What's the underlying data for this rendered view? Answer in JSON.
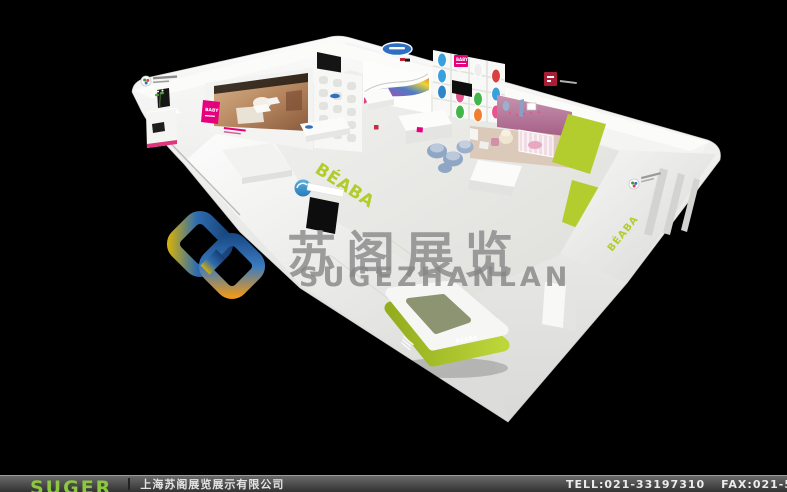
{
  "window": {
    "width": 787,
    "height": 492,
    "background": "#000000"
  },
  "booth": {
    "type": "3d-exhibition-booth-render",
    "fascia_brand": "BÉABA",
    "counter_brand": "BÉABA",
    "sidewall_brand": "BÉABA",
    "shelf_brand": "BABY",
    "left_brand": "BABY",
    "colors": {
      "structure_white": "#f2f2f0",
      "accent_lime": "#b2cc2b",
      "brand_pink": "#e6007e",
      "brand_dark_red": "#a81f35",
      "sign_blue": "#2e6fc2",
      "nursery_mauve": "#b77b9d",
      "nursery_floor_tan": "#dbc9ba",
      "product_blue": "#3aa0dc",
      "product_green": "#42b64a",
      "product_pink": "#e8558e",
      "product_orange": "#f08030",
      "product_red": "#d94040"
    }
  },
  "watermark": {
    "title": "苏阁展览",
    "subtitle": "SUGEZHANLAN",
    "text_color": "#8e8e8e",
    "logo_colors": {
      "gold": "#d2af10",
      "blue": "#1c4e8c",
      "orange": "#ee9a1a"
    }
  },
  "footer": {
    "brand": "SUGER",
    "brand_color": "#8dc63f",
    "company": "上海苏阁展览展示有限公司",
    "tel": "TELL:021-33197310",
    "fax": "FAX:021-5"
  }
}
